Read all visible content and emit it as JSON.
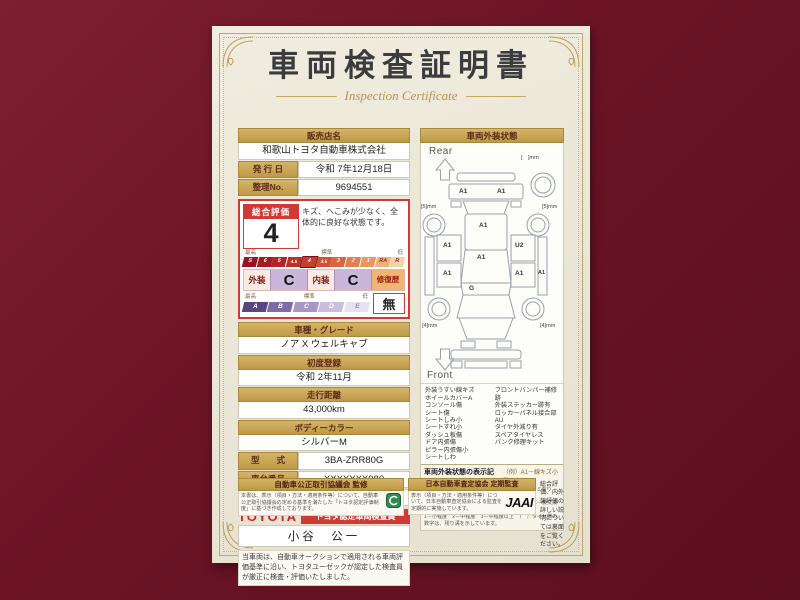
{
  "page": {
    "title": "車両検査証明書",
    "subtitle": "Inspection Certificate"
  },
  "colors": {
    "background_maroon": "#6b1424",
    "paper": "#ece7d8",
    "gold_band": "#c9a852",
    "accent_red": "#cf3a33",
    "grade_purple": "#c9b6d8",
    "repair_orange": "#f0b574",
    "toyota_red": "#d6232b"
  },
  "dealer": {
    "label": "販売店名",
    "name": "和歌山トヨタ自動車株式会社"
  },
  "issue": {
    "label": "発 行 日",
    "value": "令和 7年12月18日"
  },
  "ref": {
    "label": "整理No.",
    "value": "9694551"
  },
  "evaluation": {
    "overall_label": "総合評価",
    "score": "4",
    "comment": "キズ、へこみが少なく、全体的に良好な状態です。",
    "scale_labels": {
      "high": "最高",
      "mid": "標準",
      "low": "低"
    },
    "scale": [
      "S",
      "6",
      "5",
      "4.5",
      "4",
      "3.5",
      "3",
      "2",
      "1",
      "RA",
      "R"
    ],
    "exterior_label": "外装",
    "exterior_grade": "C",
    "interior_label": "内装",
    "interior_grade": "C",
    "repair_label": "修復歴",
    "repair_value": "無",
    "grades": [
      "A",
      "B",
      "C",
      "D",
      "E"
    ]
  },
  "fields": {
    "model": {
      "label": "車種・グレード",
      "value": "ノア X ウェルキャブ"
    },
    "first_reg": {
      "label": "初度登録",
      "value": "令和 2年11月"
    },
    "mileage": {
      "label": "走行距離",
      "value": "43,000km"
    },
    "color": {
      "label": "ボディーカラー",
      "value": "シルバーM"
    },
    "type": {
      "label": "型　　式",
      "value": "3BA-ZRR80G"
    },
    "chassis": {
      "label": "車台番号",
      "value": "XXXXXXX980"
    },
    "engine": {
      "label": "エンジン",
      "value": "ガソリン"
    }
  },
  "inspector": {
    "brand": "TOYOTA",
    "badge": "トヨタ認定車両検査員",
    "name": "小谷　公一"
  },
  "note": "当車両は、自動車オークションで適用される車両評価基準に沿い、トヨタユーゼックが認定した検査員が厳正に検査・評価いたしました。",
  "exterior": {
    "title": "車両外装状態",
    "rear_label": "Rear",
    "front_label": "Front",
    "marks": [
      "A1",
      "A1",
      "A1",
      "A1",
      "A1",
      "U2",
      "A1",
      "A1",
      "A1",
      "G"
    ],
    "tires": {
      "spare": "[　]mm",
      "rear_left": "[5]mm",
      "rear_right": "[5]mm",
      "front_left": "[4]mm",
      "front_right": "[4]mm"
    },
    "legend_left": [
      "外装うすい線キズ",
      "ホイールカバーA",
      "コンソール傷",
      "シート傷",
      "シートしみ小",
      "シートすれ小",
      "ダッシュ板傷",
      "ドア内張傷",
      "ピラー内張傷小",
      "シートしわ"
    ],
    "legend_right": [
      "フロントバンパー補修跡",
      "外装ステッカー跡有",
      "ロッカーパネル接合部AU",
      "タイヤ外減り有",
      "スペアタイヤレス",
      "パンク修理キット"
    ],
    "symbols_title": "車両外装状態の表示記号について",
    "symbols_example": "（例）A1－線キズ小程度有り",
    "symbols_lines": [
      "A－線キズ有り　U－ヘコミ有り　B－キズ＆ヘコミ有り　P－要塗装　跡－補修跡有り　S－サビ有り",
      "C－腐食有り　G－フロントガラス小キズ有り　X－要交換（裏面に明記あり）　XX－交換歴有り",
      "1－小程度　2－中程度　3－中程度以上　（　）タイヤ横の数字は、残り溝を示しています。"
    ]
  },
  "footer": {
    "left_title": "自動車公正取引協議会 監修",
    "left_text": "本書は、表示（項目・方法・適用条件等）について、自動車公正取引協議会の定める基準を満たした「トヨタ認定評価制度」に基づき作成しております。",
    "right_title": "日本自動車査定協会 定期監査",
    "right_text": "表示（項目・方法・適用条件等）について、日本自動車査定協会による監査を定期的に実施しています。",
    "jaai": "JAAI",
    "back_note": "総合評価、内外装評価の詳しい説明については裏面をご覧ください。"
  }
}
